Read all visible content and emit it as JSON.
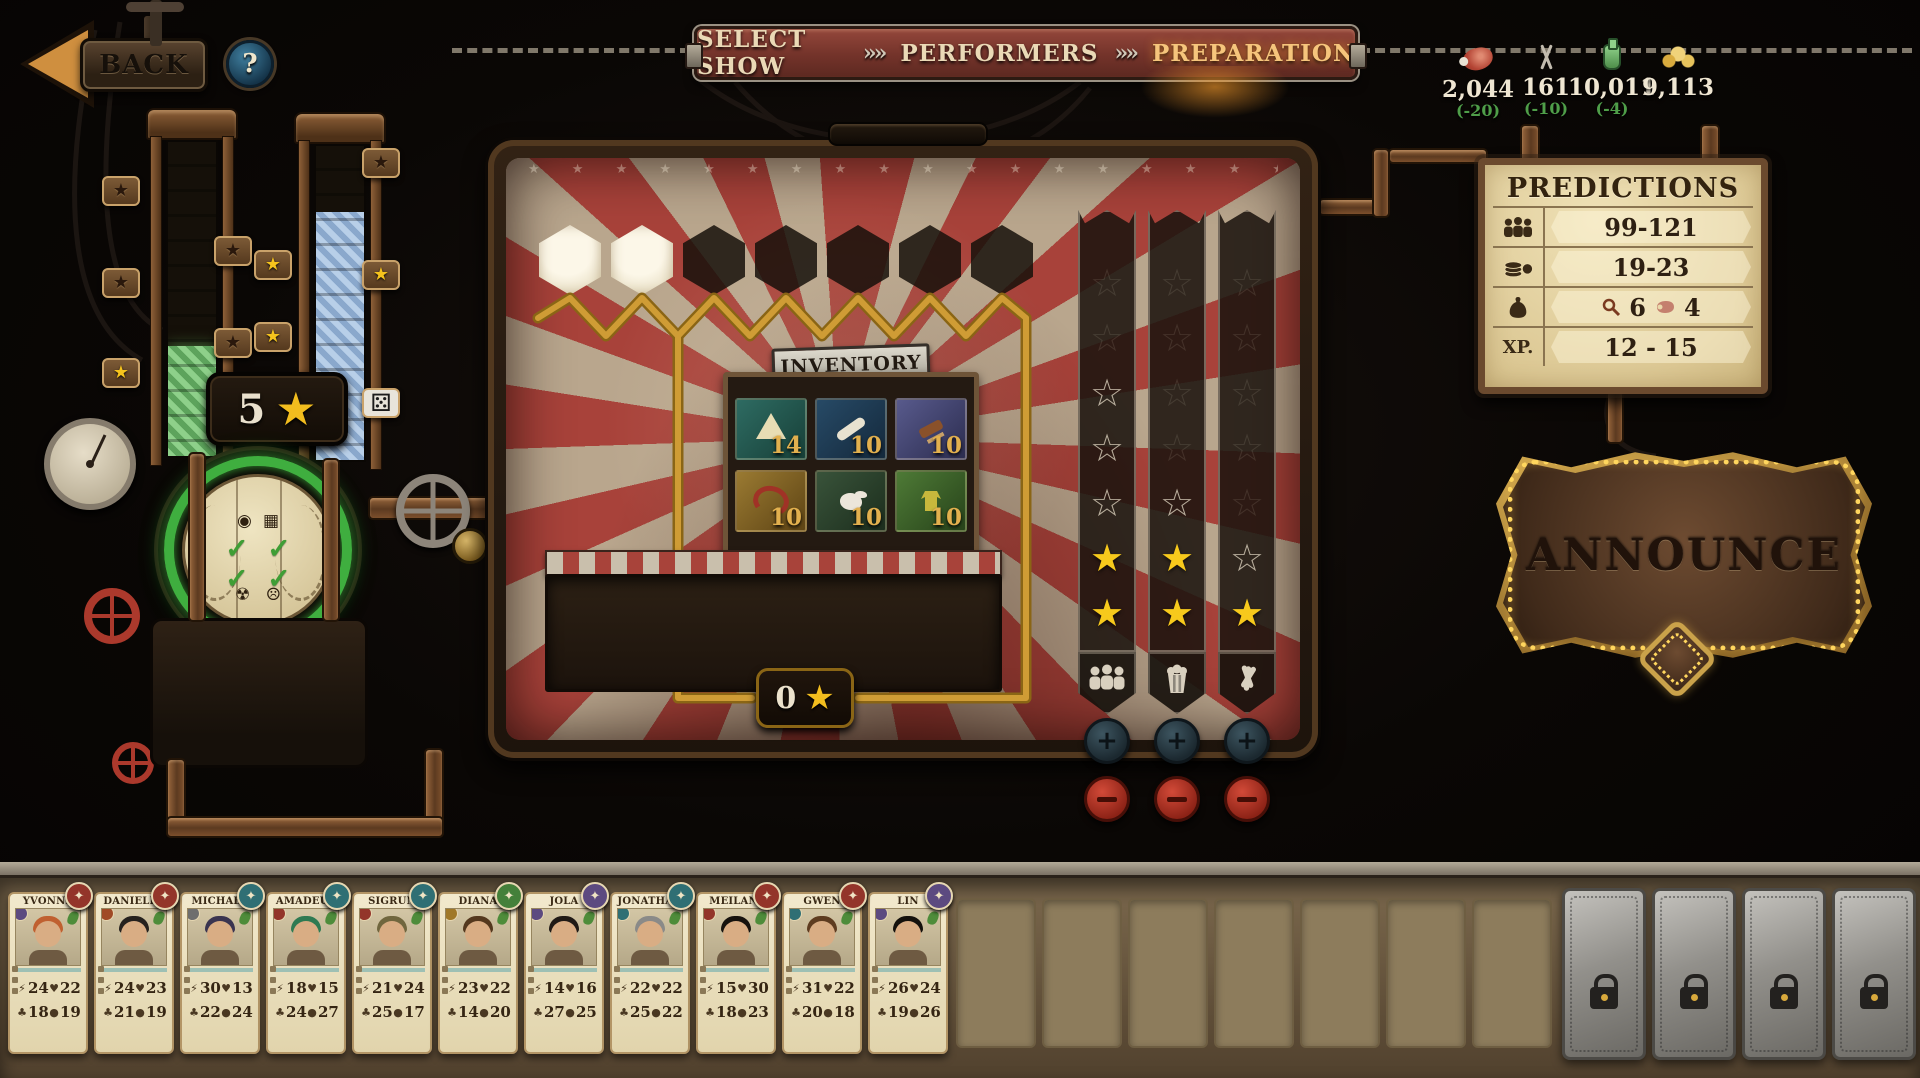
{
  "top_bar": {
    "back_label": "BACK",
    "help_label": "?",
    "separator": "»»",
    "steps": [
      {
        "label": "SELECT SHOW",
        "active": false
      },
      {
        "label": "PERFORMERS",
        "active": false
      },
      {
        "label": "PREPARATION",
        "active": true
      }
    ],
    "resources": [
      {
        "icon": "meat-icon",
        "value": "2,044",
        "delta": "(-20)"
      },
      {
        "icon": "cutlery-icon",
        "value": "161",
        "delta": "(-10)"
      },
      {
        "icon": "flask-icon",
        "value": "10,011",
        "delta": "(-4)"
      },
      {
        "icon": "coins-icon",
        "value": "9,113",
        "delta": ""
      }
    ]
  },
  "machine": {
    "score_badge": {
      "value": "5",
      "star": "★"
    },
    "tower1_tags": [
      "dark",
      "dark",
      "gold",
      "dark",
      "dark",
      "gold"
    ],
    "tower2_tags": [
      "gold",
      "gold",
      "dark",
      "gold",
      "dice"
    ],
    "dial_icons": [
      "mask-icon",
      "crate-icon",
      "radiation-icon",
      "sad-face-icon"
    ],
    "dial_checks": [
      "✓",
      "✓",
      "✓",
      "✓"
    ]
  },
  "stage": {
    "hex_slots": [
      "filled",
      "filled",
      "empty",
      "empty",
      "empty",
      "empty",
      "empty"
    ],
    "inventory": {
      "title": "INVENTORY",
      "items": [
        {
          "name": "tent-item",
          "count": "14"
        },
        {
          "name": "bone-item",
          "count": "10"
        },
        {
          "name": "tool-item",
          "count": "10"
        },
        {
          "name": "harness-item",
          "count": "10"
        },
        {
          "name": "poodle-item",
          "count": "10"
        },
        {
          "name": "costume-item",
          "count": "10"
        }
      ]
    },
    "star_counter": {
      "value": "0",
      "star": "★"
    },
    "columns": [
      {
        "icon": "audience-icon",
        "slots": [
          "faint",
          "faint",
          "outline",
          "outline",
          "outline",
          "filled",
          "filled"
        ]
      },
      {
        "icon": "popcorn-icon",
        "slots": [
          "faint",
          "faint",
          "faint",
          "faint",
          "outline",
          "filled",
          "filled"
        ]
      },
      {
        "icon": "props-icon",
        "slots": [
          "faint",
          "faint",
          "faint",
          "faint",
          "faint",
          "outline",
          "filled"
        ]
      }
    ]
  },
  "predictions": {
    "title": "PREDICTIONS",
    "rows": [
      {
        "icon": "audience-icon",
        "value": "99-121"
      },
      {
        "icon": "money-icon",
        "value": "19-23"
      },
      {
        "icon": "bag-icon",
        "value": "6",
        "value2": "4"
      },
      {
        "label": "XP.",
        "value": "12 - 15"
      }
    ]
  },
  "announce": {
    "label": "ANNOUNCE"
  },
  "roster": {
    "performers": [
      {
        "name": "YVONNE",
        "badge": "#93352a",
        "type": "#5c4a80",
        "hair": "#c06030",
        "stats": [
          "24",
          "22",
          "18",
          "19"
        ]
      },
      {
        "name": "DANIELLE",
        "badge": "#93352a",
        "type": "#a04a26",
        "hair": "#26211e",
        "stats": [
          "24",
          "23",
          "21",
          "19"
        ]
      },
      {
        "name": "MICHAEL",
        "badge": "#2f6f74",
        "type": "#6e6e6e",
        "hair": "#3a3450",
        "stats": [
          "30",
          "13",
          "22",
          "24"
        ]
      },
      {
        "name": "AMADEUS",
        "badge": "#2f6f74",
        "type": "#93352a",
        "hair": "#2e7a52",
        "stats": [
          "18",
          "15",
          "24",
          "27"
        ]
      },
      {
        "name": "SIGRUN",
        "badge": "#2f6f74",
        "type": "#93352a",
        "hair": "#70663e",
        "stats": [
          "21",
          "24",
          "25",
          "17"
        ]
      },
      {
        "name": "DIANA",
        "badge": "#44803a",
        "type": "#a07828",
        "hair": "#54381e",
        "stats": [
          "23",
          "22",
          "14",
          "20"
        ]
      },
      {
        "name": "JOLA",
        "badge": "#5c4a80",
        "type": "#5c4a80",
        "hair": "#201a16",
        "stats": [
          "14",
          "16",
          "27",
          "25"
        ]
      },
      {
        "name": "JONATHAN",
        "badge": "#2f6f74",
        "type": "#2f6f74",
        "hair": "#8a8a88",
        "stats": [
          "22",
          "22",
          "25",
          "22"
        ]
      },
      {
        "name": "MEILANI",
        "badge": "#93352a",
        "type": "#93352a",
        "hair": "#16120e",
        "stats": [
          "15",
          "30",
          "18",
          "23"
        ]
      },
      {
        "name": "GWEN",
        "badge": "#93352a",
        "type": "#2f6f74",
        "hair": "#5e3c20",
        "stats": [
          "31",
          "22",
          "20",
          "18"
        ]
      },
      {
        "name": "LIN",
        "badge": "#5c4a80",
        "type": "#5c4a80",
        "hair": "#14100c",
        "stats": [
          "26",
          "24",
          "19",
          "26"
        ]
      }
    ],
    "empty_slot_count": 7,
    "locked_slot_count": 4
  }
}
